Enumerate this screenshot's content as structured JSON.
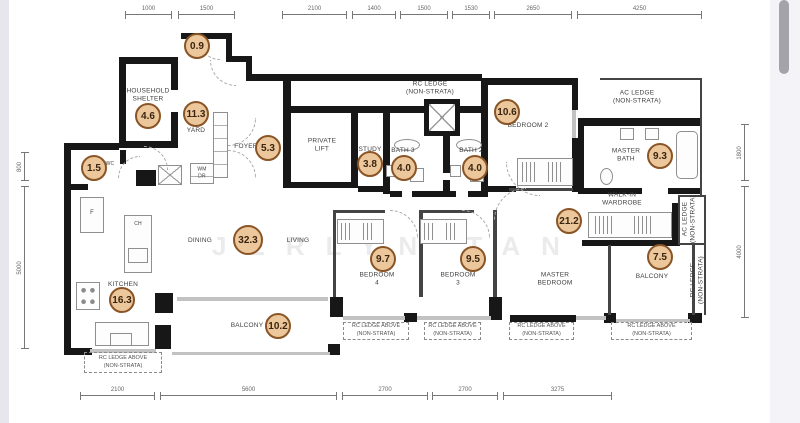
{
  "watermark": {
    "text": "JERLYN TAN"
  },
  "palette": {
    "badge_fill": "#ecc79b",
    "badge_border": "#8a5526",
    "badge_text": "#3a2410",
    "wall": "#171717",
    "label_text": "#3f3f3f"
  },
  "area_badges": [
    {
      "room": "yard-ac",
      "value": "0.9",
      "x": 197,
      "y": 46
    },
    {
      "room": "household-shelter",
      "value": "4.6",
      "x": 148,
      "y": 116
    },
    {
      "room": "yard",
      "value": "11.3",
      "x": 196,
      "y": 114
    },
    {
      "room": "foyer",
      "value": "5.3",
      "x": 268,
      "y": 148
    },
    {
      "room": "wc",
      "value": "1.5",
      "x": 94,
      "y": 168
    },
    {
      "room": "study",
      "value": "3.8",
      "x": 370,
      "y": 164
    },
    {
      "room": "bath-3",
      "value": "4.0",
      "x": 404,
      "y": 168
    },
    {
      "room": "bath-2",
      "value": "4.0",
      "x": 475,
      "y": 168
    },
    {
      "room": "bedroom-2",
      "value": "10.6",
      "x": 507,
      "y": 112
    },
    {
      "room": "master-bath",
      "value": "9.3",
      "x": 660,
      "y": 156
    },
    {
      "room": "master-bedroom",
      "value": "21.2",
      "x": 569,
      "y": 221
    },
    {
      "room": "living-dining",
      "value": "32.3",
      "x": 248,
      "y": 240,
      "size": 30
    },
    {
      "room": "bedroom-4",
      "value": "9.7",
      "x": 383,
      "y": 259
    },
    {
      "room": "bedroom-3",
      "value": "9.5",
      "x": 473,
      "y": 259
    },
    {
      "room": "master-balcony",
      "value": "7.5",
      "x": 660,
      "y": 257
    },
    {
      "room": "kitchen",
      "value": "16.3",
      "x": 122,
      "y": 300
    },
    {
      "room": "balcony",
      "value": "10.2",
      "x": 278,
      "y": 326
    }
  ],
  "room_labels": [
    {
      "id": "household-shelter",
      "lines": [
        "HOUSEHOLD",
        "SHELTER"
      ],
      "x": 148,
      "y": 96
    },
    {
      "id": "yard",
      "lines": [
        "YARD"
      ],
      "x": 196,
      "y": 131
    },
    {
      "id": "foyer",
      "lines": [
        "FOYER"
      ],
      "x": 246,
      "y": 147
    },
    {
      "id": "private-lift",
      "lines": [
        "PRIVATE",
        "LIFT"
      ],
      "x": 322,
      "y": 146
    },
    {
      "id": "study",
      "lines": [
        "STUDY"
      ],
      "x": 370,
      "y": 150
    },
    {
      "id": "bath-3",
      "lines": [
        "BATH 3"
      ],
      "x": 403,
      "y": 151
    },
    {
      "id": "bath-2",
      "lines": [
        "BATH 2"
      ],
      "x": 471,
      "y": 151
    },
    {
      "id": "bedroom-2",
      "lines": [
        "BEDROOM 2"
      ],
      "x": 528,
      "y": 126
    },
    {
      "id": "rc-ledge-top",
      "lines": [
        "RC LEDGE",
        "(NON-STRATA)"
      ],
      "x": 430,
      "y": 89
    },
    {
      "id": "ac-ledge-top",
      "lines": [
        "AC LEDGE",
        "(NON-STRATA)"
      ],
      "x": 637,
      "y": 98
    },
    {
      "id": "master-bath",
      "lines": [
        "MASTER",
        "BATH"
      ],
      "x": 626,
      "y": 156
    },
    {
      "id": "walk-in-wardrobe",
      "lines": [
        "WALK-IN",
        "WARDROBE"
      ],
      "x": 622,
      "y": 200
    },
    {
      "id": "master-bedroom",
      "lines": [
        "MASTER",
        "BEDROOM"
      ],
      "x": 555,
      "y": 280
    },
    {
      "id": "bedroom-4",
      "lines": [
        "BEDROOM",
        "4"
      ],
      "x": 377,
      "y": 280
    },
    {
      "id": "bedroom-3",
      "lines": [
        "BEDROOM",
        "3"
      ],
      "x": 458,
      "y": 280
    },
    {
      "id": "dining",
      "lines": [
        "DINING"
      ],
      "x": 200,
      "y": 241
    },
    {
      "id": "living",
      "lines": [
        "LIVING"
      ],
      "x": 298,
      "y": 241
    },
    {
      "id": "kitchen",
      "lines": [
        "KITCHEN"
      ],
      "x": 123,
      "y": 285
    },
    {
      "id": "balcony",
      "lines": [
        "BALCONY"
      ],
      "x": 247,
      "y": 326
    },
    {
      "id": "master-balcony",
      "lines": [
        "BALCONY"
      ],
      "x": 652,
      "y": 277
    },
    {
      "id": "wc",
      "lines": [
        "WC"
      ],
      "x": 110,
      "y": 164,
      "size": 5
    },
    {
      "id": "washer-dryer",
      "lines": [
        "WM",
        "DR"
      ],
      "x": 202,
      "y": 173,
      "size": 5
    },
    {
      "id": "fridge",
      "lines": [
        "F"
      ],
      "x": 92,
      "y": 214,
      "size": 6
    },
    {
      "id": "cooker-hood",
      "lines": [
        "CH"
      ],
      "x": 138,
      "y": 224,
      "size": 5
    }
  ],
  "side_labels": [
    {
      "id": "ac-ledge-right",
      "lines": [
        "AC LEDGE",
        "(NON-STRATA)"
      ],
      "x": 690,
      "y": 219
    },
    {
      "id": "rc-ledge-right",
      "lines": [
        "RC LEDGE",
        "(NON-STRATA)"
      ],
      "x": 698,
      "y": 280
    }
  ],
  "ledge_boxes": [
    {
      "id": "rc-ledge-kitchen",
      "lines": [
        "RC LEDGE ABOVE",
        "(NON-STRATA)"
      ],
      "x": 84,
      "y": 352,
      "w": 78,
      "h": 21
    },
    {
      "id": "rc-ledge-bedroom-4",
      "lines": [
        "RC LEDGE ABOVE",
        "(NON-STRATA)"
      ],
      "x": 343,
      "y": 322,
      "w": 66,
      "h": 18
    },
    {
      "id": "rc-ledge-bedroom-3",
      "lines": [
        "RC LEDGE ABOVE",
        "(NON-STRATA)"
      ],
      "x": 424,
      "y": 322,
      "w": 57,
      "h": 18
    },
    {
      "id": "rc-ledge-master-bedroom",
      "lines": [
        "RC LEDGE ABOVE",
        "(NON-STRATA)"
      ],
      "x": 509,
      "y": 322,
      "w": 65,
      "h": 18
    },
    {
      "id": "rc-ledge-master-balcony",
      "lines": [
        "RC LEDGE ABOVE",
        "(NON-STRATA)"
      ],
      "x": 611,
      "y": 322,
      "w": 81,
      "h": 18
    }
  ],
  "dimensions": {
    "top_y": 14,
    "top": [
      {
        "value": "1000",
        "from": 125,
        "to": 172
      },
      {
        "value": "1500",
        "from": 178,
        "to": 235
      },
      {
        "value": "2100",
        "from": 282,
        "to": 347
      },
      {
        "value": "1400",
        "from": 352,
        "to": 396
      },
      {
        "value": "1500",
        "from": 400,
        "to": 448
      },
      {
        "value": "1530",
        "from": 452,
        "to": 490
      },
      {
        "value": "2650",
        "from": 494,
        "to": 572
      },
      {
        "value": "4250",
        "from": 577,
        "to": 702
      }
    ],
    "bottom_y": 395,
    "bottom": [
      {
        "value": "2100",
        "from": 80,
        "to": 155
      },
      {
        "value": "5600",
        "from": 160,
        "to": 337
      },
      {
        "value": "2700",
        "from": 342,
        "to": 428
      },
      {
        "value": "2700",
        "from": 432,
        "to": 498
      },
      {
        "value": "3275",
        "from": 503,
        "to": 612
      }
    ],
    "left_x": 24,
    "left": [
      {
        "value": "800",
        "from": 152,
        "to": 181
      },
      {
        "value": "5000",
        "from": 186,
        "to": 349
      }
    ],
    "right_x": 744,
    "right": [
      {
        "value": "1800",
        "from": 124,
        "to": 181
      },
      {
        "value": "4000",
        "from": 186,
        "to": 318
      }
    ]
  }
}
